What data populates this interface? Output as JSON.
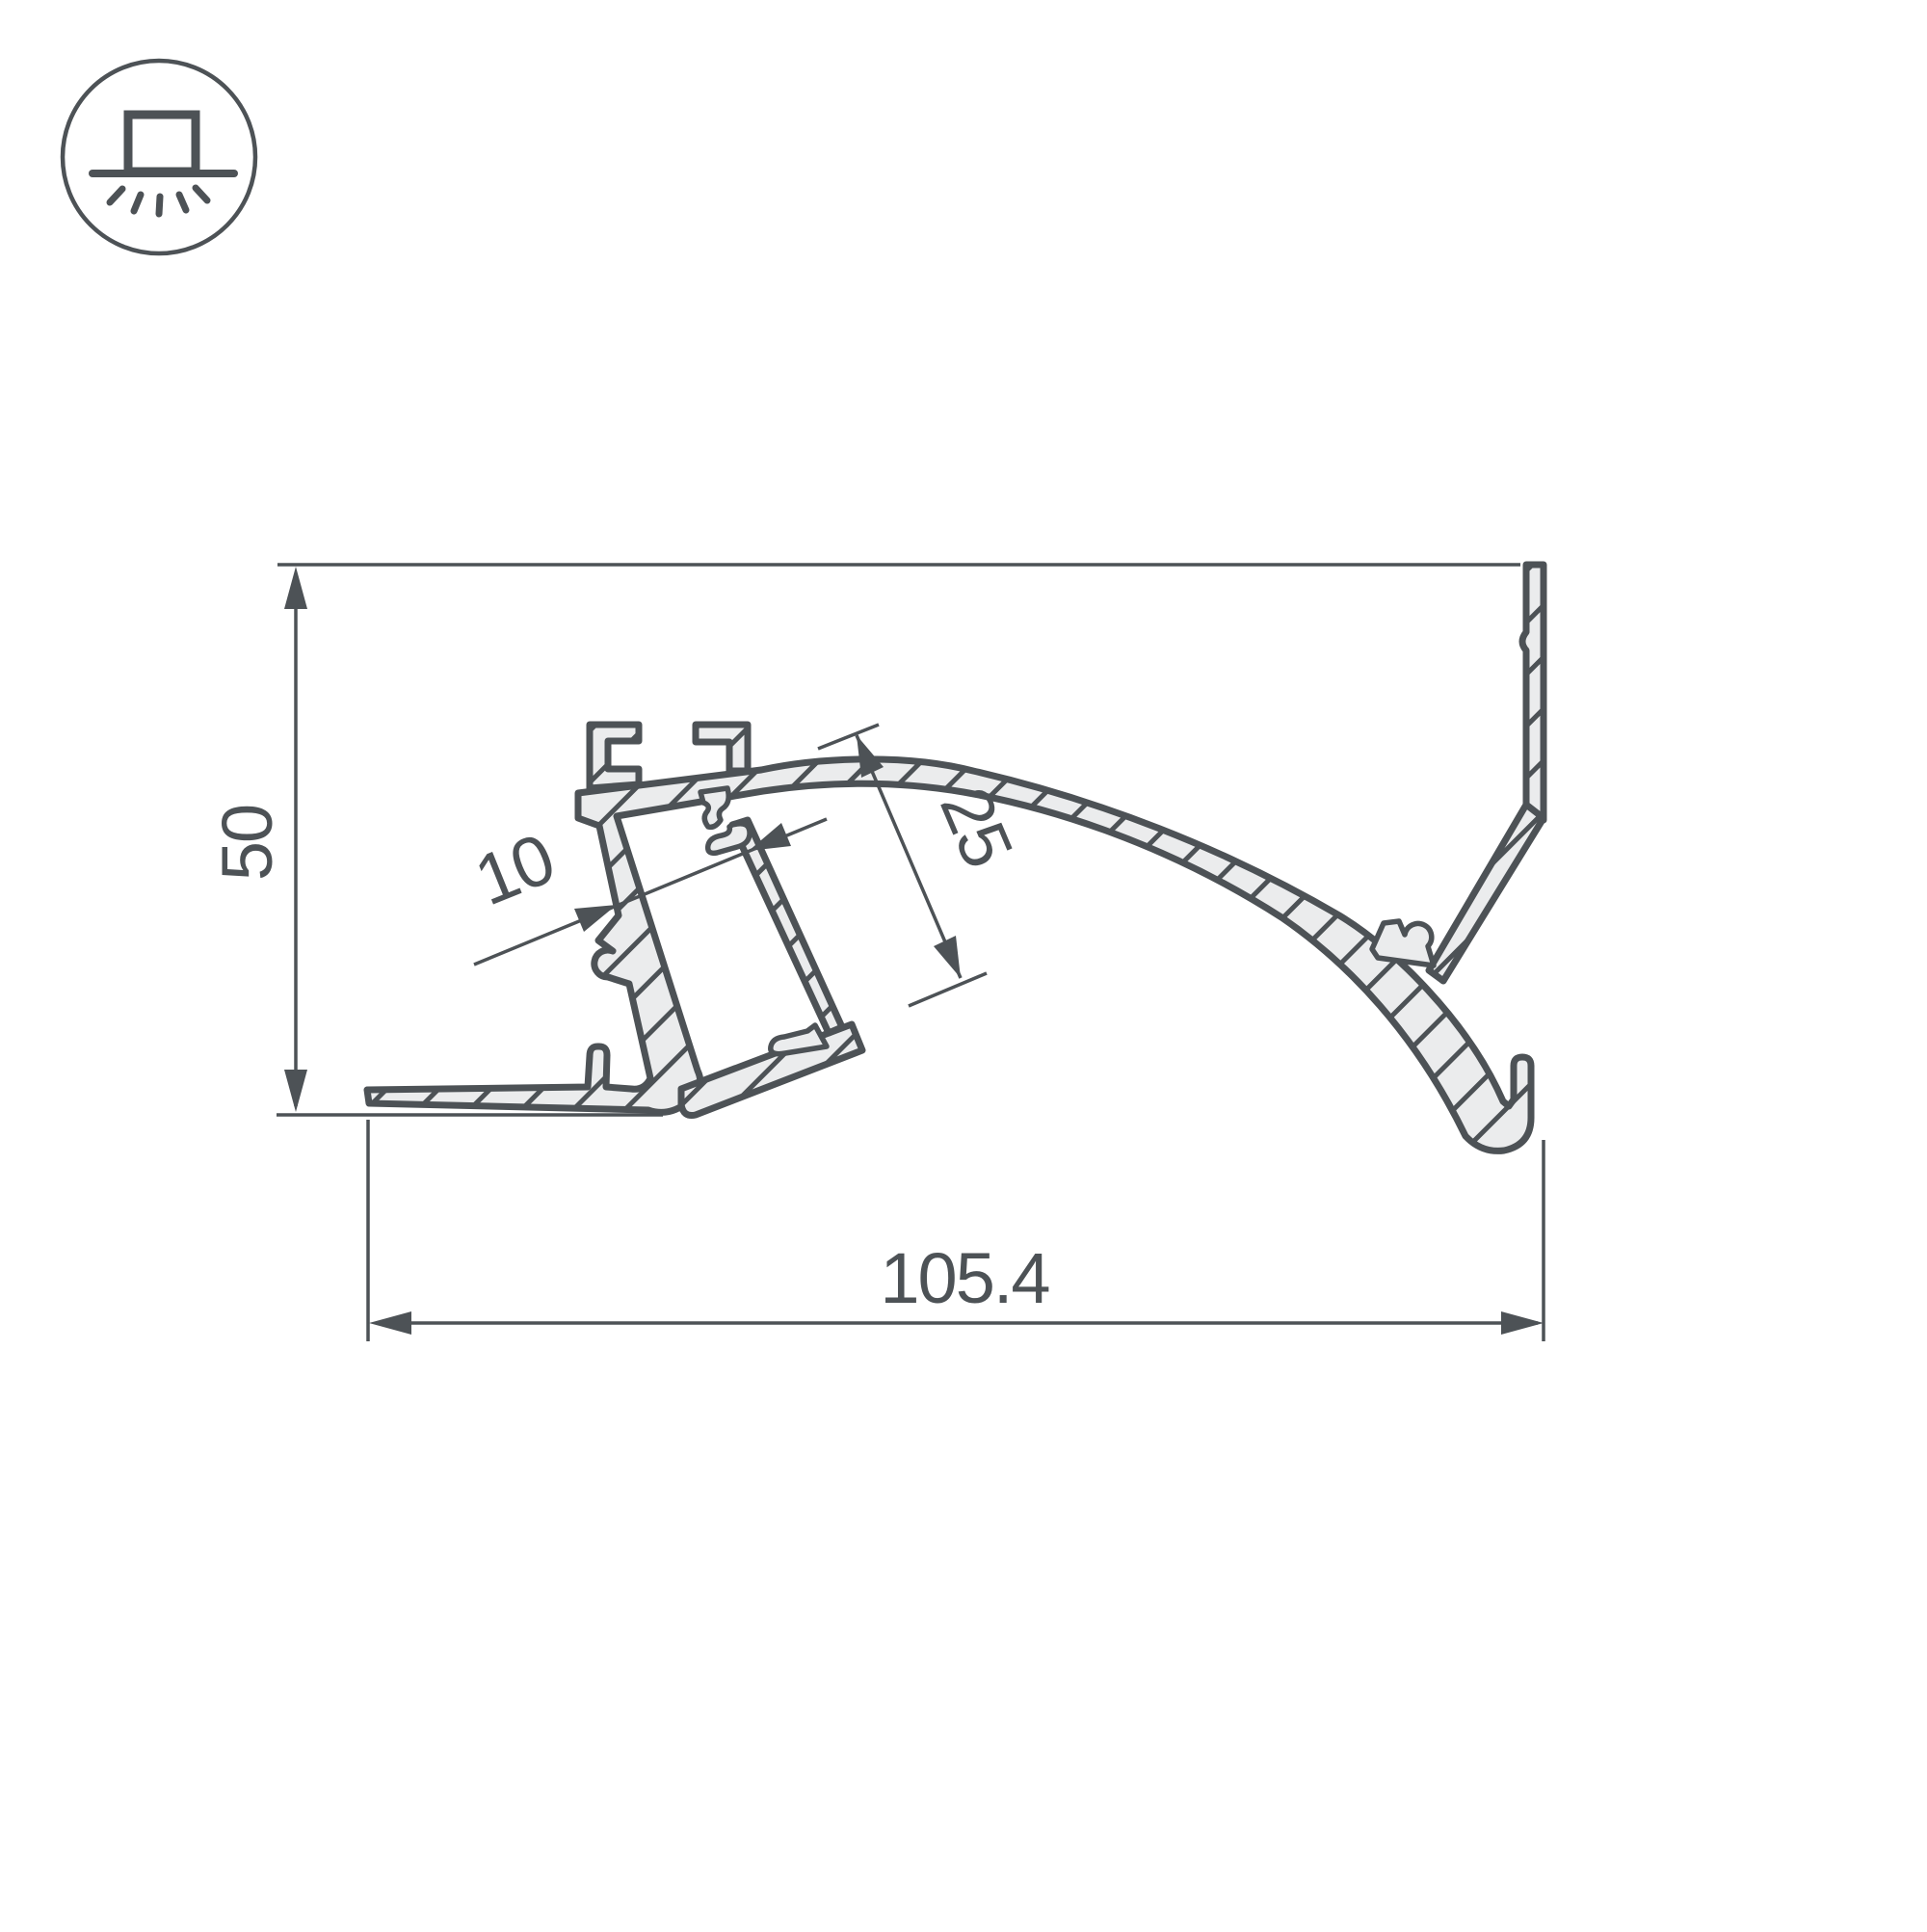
{
  "page": {
    "background": "#ffffff"
  },
  "drawing": {
    "kind": "profile-cross-section",
    "line_color": "#4d5256",
    "material_fill": "#ebeced",
    "labels": {
      "height": "50",
      "overall_width": "105.4",
      "channel_depth": "25",
      "channel_width": "10"
    },
    "icon": "surface-mount-downlight"
  }
}
